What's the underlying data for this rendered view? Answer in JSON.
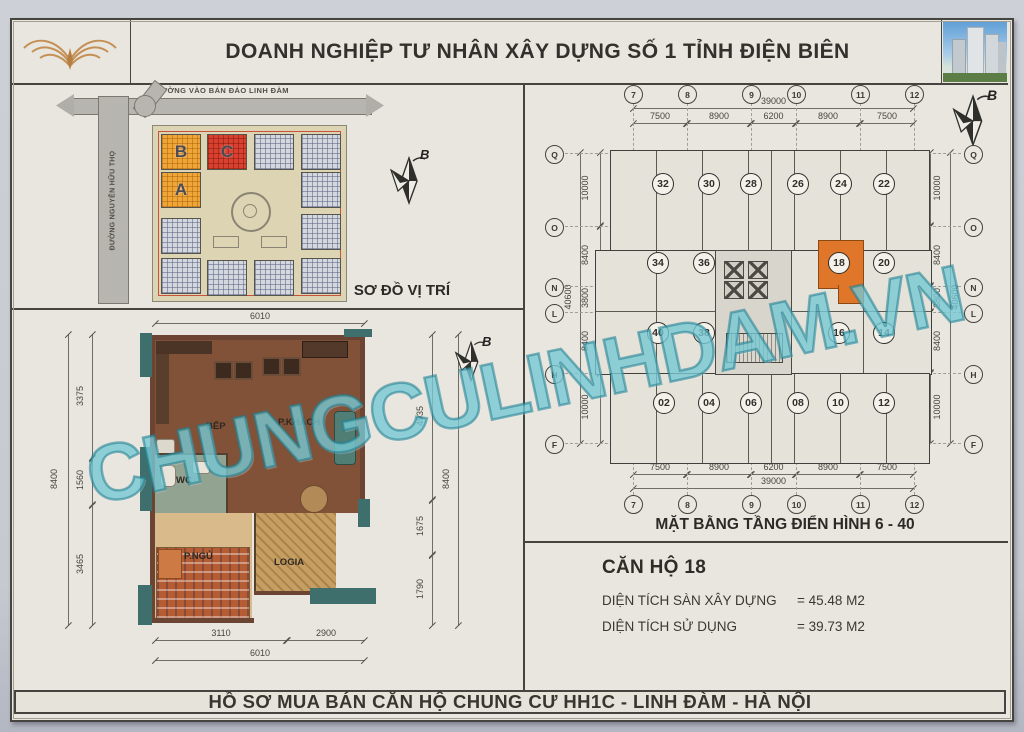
{
  "header": {
    "title": "DOANH NGHIỆP TƯ NHÂN XÂY DỰNG SỐ 1 TỈNH ĐIỆN BIÊN"
  },
  "footer": {
    "title": "HỒ SƠ MUA BÁN CĂN HỘ CHUNG CƯ HH1C - LINH ĐÀM - HÀ NỘI"
  },
  "watermark": {
    "text": "CHUNGCULINHDAM.VN"
  },
  "site_plan": {
    "title": "SƠ ĐỒ VỊ TRÍ",
    "road_top": "ĐƯỜNG VÀO BÁN ĐẢO LINH ĐÀM",
    "road_left": "ĐƯỜNG NGUYỄN HỮU THỌ",
    "block_b": "B",
    "block_c": "C",
    "block_a": "A",
    "north_label": "B"
  },
  "apartment_plan": {
    "north_label": "B",
    "rooms": {
      "kitchen": "BẾP",
      "living": "P.KHÁCH",
      "wc": "WC",
      "bedroom": "P.NGỦ",
      "loggia": "LOGIA"
    },
    "dims": {
      "top_total": "6010",
      "left_total": "8400",
      "left_segments": [
        "3375",
        "1560",
        "3465"
      ],
      "right_total": "8400",
      "right_segments": [
        "4935",
        "1675",
        "1790"
      ],
      "bottom_segments": [
        "3110",
        "2900"
      ],
      "bottom_total": "6010"
    }
  },
  "floor_plan": {
    "title": "MẶT BẰNG TẦNG ĐIỂN HÌNH 6 - 40",
    "north_label": "B",
    "grid_columns": [
      "7",
      "8",
      "9",
      "10",
      "11",
      "12"
    ],
    "grid_rows": [
      "Q",
      "O",
      "N",
      "L",
      "H",
      "F"
    ],
    "width_total": "39000",
    "width_segments": [
      "7500",
      "8900",
      "6200",
      "8900",
      "7500"
    ],
    "height_total": "40600",
    "height_segments": [
      "10000",
      "8400",
      "3800",
      "8400",
      "10000"
    ],
    "units_row1": [
      "32",
      "30",
      "28",
      "26",
      "24",
      "22"
    ],
    "units_row2": [
      "34",
      "36",
      "18",
      "20"
    ],
    "units_row3": [
      "40",
      "38",
      "16",
      "14"
    ],
    "units_row4": [
      "02",
      "04",
      "06",
      "08",
      "10",
      "12"
    ],
    "highlighted_unit": "18"
  },
  "unit_info": {
    "title": "CĂN HỘ 18",
    "rows": [
      {
        "label": "DIỆN TÍCH SÀN XÂY DỰNG",
        "value": "= 45.48 M2"
      },
      {
        "label": "DIỆN TÍCH SỬ DỤNG",
        "value": "= 39.73 M2"
      }
    ]
  },
  "colors": {
    "watermark_teal": "#68c2ce",
    "highlight_unit_orange": "#e0762a",
    "block_orange": "#f0a636",
    "block_red": "#d8402f",
    "paper": "#e9e6df"
  }
}
